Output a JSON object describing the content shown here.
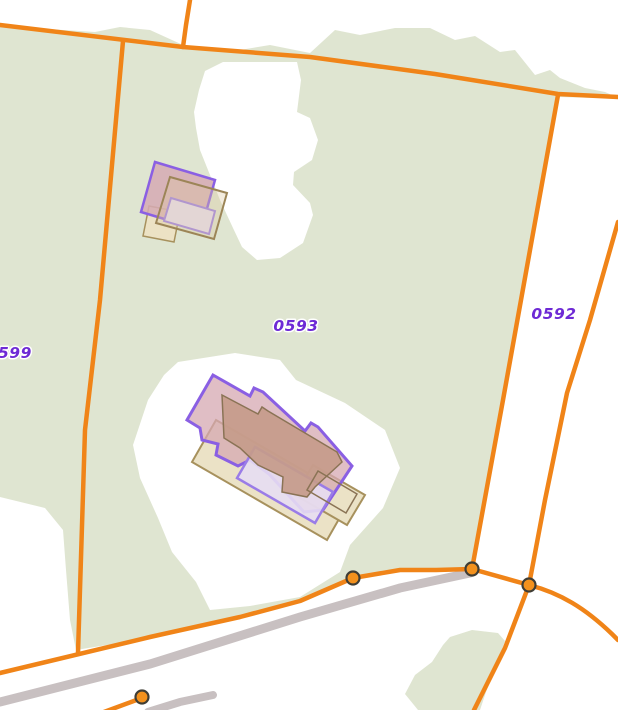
{
  "map": {
    "parcels": [
      {
        "id": "0599",
        "label": "599"
      },
      {
        "id": "0593",
        "label": "0593"
      },
      {
        "id": "0592",
        "label": "0592"
      }
    ],
    "colors": {
      "background": "#ffffff",
      "vegetation_green": "#dfe5d1",
      "boundary_orange": "#f08418",
      "road_gray": "#c8c0c1",
      "building_fill_pink": "#d5aab4",
      "building_outline_purple": "#8a5fe3",
      "building_fill_tan": "#ebe2c6",
      "building_outline_brown": "#9c8557",
      "building_fill_lavender": "#e7def2",
      "building_fill_brown": "#c69b8a",
      "parcel_label_purple": "#6e2ad5",
      "vertex_fill": "#f3911d",
      "vertex_outline": "#3f3d35"
    },
    "vertex_count": 4
  }
}
